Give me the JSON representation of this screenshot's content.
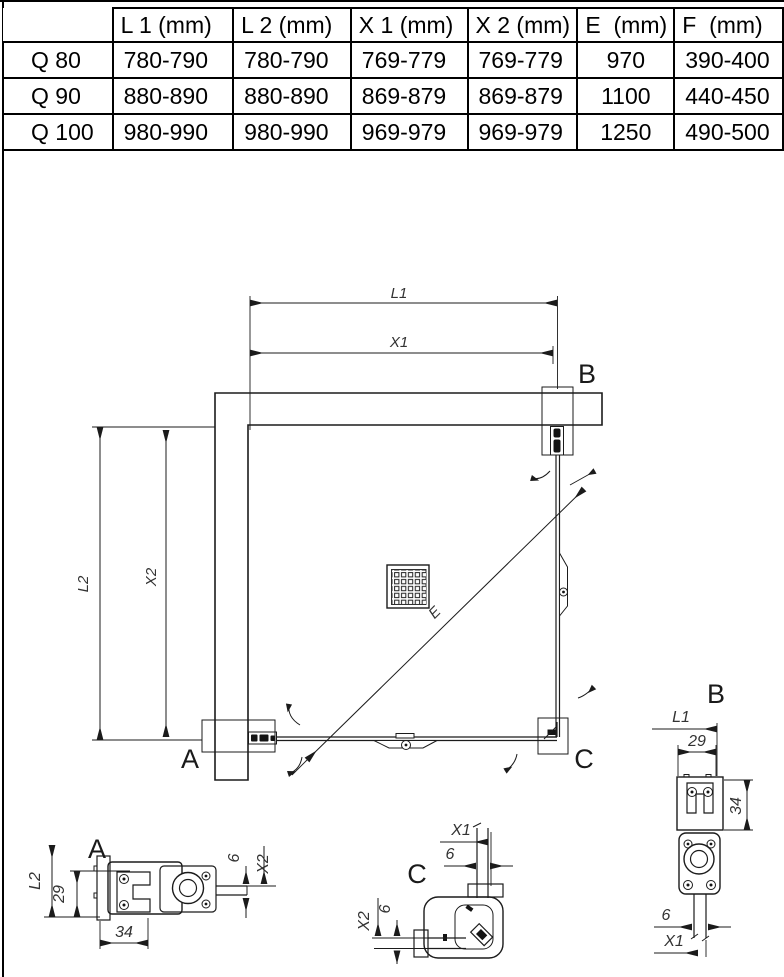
{
  "colors": {
    "line": "#1b1b1b",
    "dim_text": "#333333",
    "table_text": "#000000"
  },
  "table": {
    "corner": "",
    "headers": [
      "L 1 (mm)",
      "L 2 (mm)",
      "X 1 (mm)",
      "X 2 (mm)",
      "E  (mm)",
      "F  (mm)"
    ],
    "rows": [
      {
        "name": "Q 80",
        "l1": "780-790",
        "l2": "780-790",
        "x1": "769-779",
        "x2": "769-779",
        "e": "970",
        "f": "390-400"
      },
      {
        "name": "Q 90",
        "l1": "880-890",
        "l2": "880-890",
        "x1": "869-879",
        "x2": "869-879",
        "e": "1100",
        "f": "440-450"
      },
      {
        "name": "Q 100",
        "l1": "980-990",
        "l2": "980-990",
        "x1": "969-979",
        "x2": "969-979",
        "e": "1250",
        "f": "490-500"
      }
    ]
  },
  "plan": {
    "dims": {
      "l1": "L1",
      "x1": "X1",
      "l2": "L2",
      "x2": "X2",
      "e": "E"
    },
    "labels": {
      "a": "A",
      "b": "B",
      "c": "C"
    }
  },
  "detail_a": {
    "label": "A",
    "dim_l2": "L2",
    "dim_29": "29",
    "dim_34": "34",
    "dim_6": "6",
    "dim_x2": "X2"
  },
  "detail_b": {
    "label": "B",
    "dim_l1": "L1",
    "dim_29": "29",
    "dim_34": "34",
    "dim_6": "6",
    "dim_x1": "X1"
  },
  "detail_c": {
    "label": "C",
    "dim_x1": "X1",
    "dim_6_top": "6",
    "dim_x2": "X2",
    "dim_6_left": "6"
  }
}
